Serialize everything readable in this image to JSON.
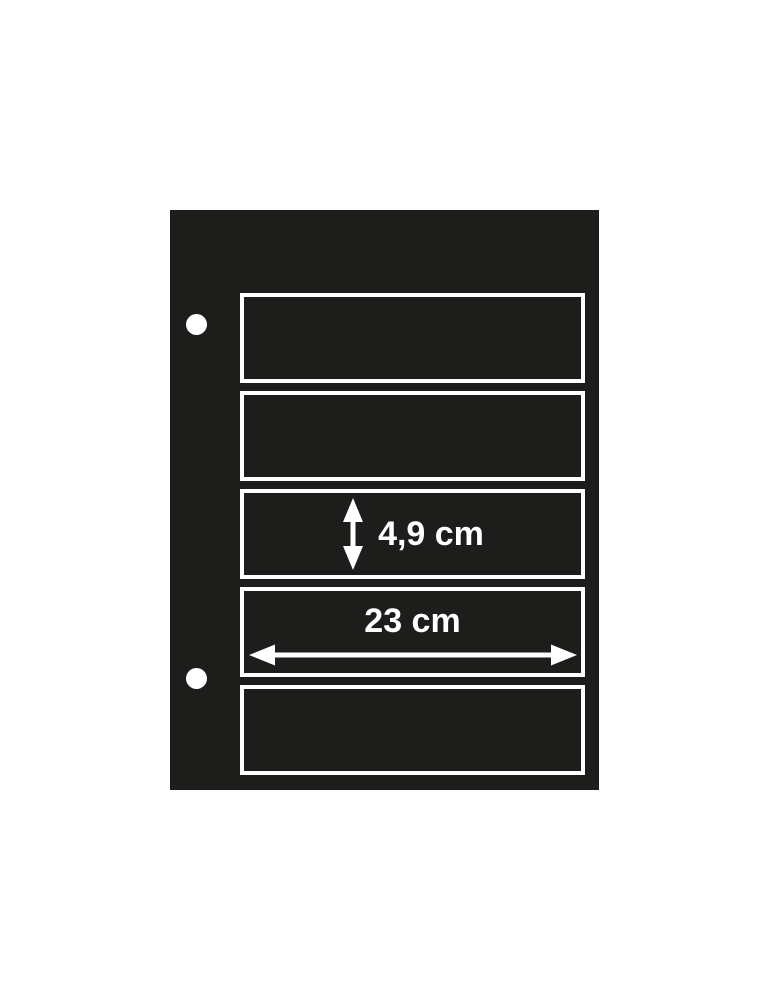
{
  "scene": {
    "type": "product-diagram",
    "subject": "black binder stock sheet with five horizontal pockets",
    "background_color": "#ffffff",
    "sheet_color": "#1d1d1b",
    "line_color": "#ffffff",
    "pocket_count": 5,
    "binder_hole_count": 2
  },
  "dimensions": {
    "pocket_height": {
      "label": "4,9 cm",
      "icon": "vertical-double-arrow-icon"
    },
    "pocket_width": {
      "label": "23 cm",
      "icon": "horizontal-double-arrow-icon"
    }
  }
}
